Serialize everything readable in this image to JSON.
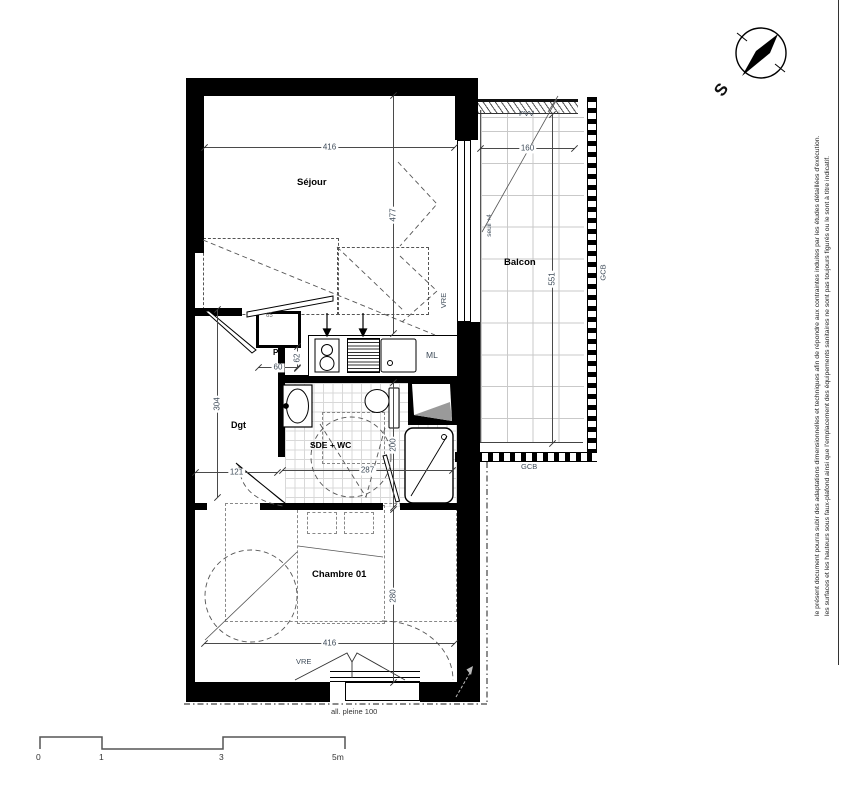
{
  "compass": {
    "label": "S"
  },
  "disclaimer": {
    "line1": "le présent document pourra subir des adaptations dimensionnelles et techniques afin de répondre aux contraintes induites par les études détaillées d'exécution.",
    "line2": "les surfaces et les hauteurs sous faux-plafond ainsi que l'emplacement des équipements sanitaires ne sont pas toujours figurés ou le sont à titre indicatif."
  },
  "rooms": {
    "sejour": "Séjour",
    "balcon": "Balcon",
    "chambre": "Chambre 01",
    "sde": "SDE + WC",
    "dgt": "Dgt",
    "pl": "Pl",
    "ml": "ML"
  },
  "labels": {
    "pvv": "PVV",
    "vre_sejour": "VRE",
    "vre_chambre": "VRE",
    "gcb_right": "GCB",
    "gcb_bottom": "GCB",
    "seuil": "seuil +4",
    "allege": "all. pleine 100"
  },
  "dimensions": {
    "sejour_width": "416",
    "sejour_height": "477",
    "balcon_width": "160",
    "balcon_height": "551",
    "pl_width": "60",
    "pl_height": "62",
    "pl_door": "65",
    "dgt_height": "304",
    "dgt_width": "121",
    "sde_width": "287",
    "sde_height": "200",
    "chambre_height": "280",
    "chambre_width": "416"
  },
  "scale_bar": {
    "t0": "0",
    "t1": "1",
    "t3": "3",
    "t5": "5m"
  },
  "colors": {
    "wall": "#000000",
    "dim_text": "#3f4c5a",
    "tile_grid": "#d8d8d8",
    "balcony_grid": "#c9c9c9"
  }
}
